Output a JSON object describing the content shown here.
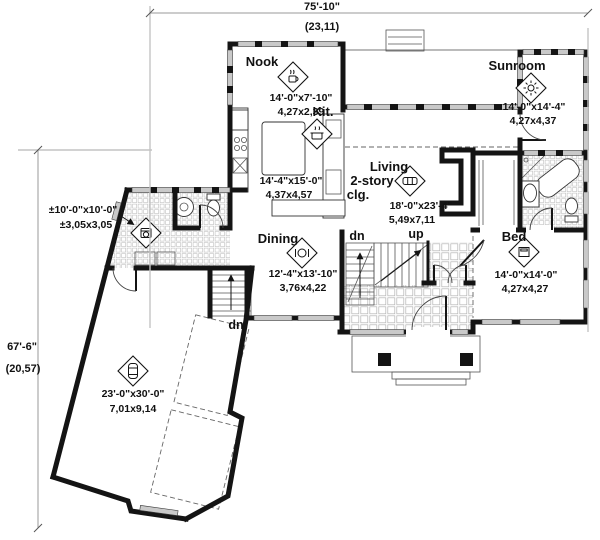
{
  "colors": {
    "wall": "#141414",
    "window_fill": "#c9c9c9",
    "dimension_line": "#9a9a9a",
    "text": "#111111"
  },
  "dimensions": {
    "overall_width_ft": "75'-10\"",
    "overall_width_m": "(23,11)",
    "overall_height_ft": "67'-6\"",
    "overall_height_m": "(20,57)"
  },
  "rooms": {
    "nook": {
      "label": "Nook",
      "size_ft": "14'-0\"x7'-10\"",
      "size_m": "4,27x2,39",
      "icon": "coffee-cup-icon"
    },
    "kitchen": {
      "label": "Kit.",
      "size_ft": "14'-4\"x15'-0\"",
      "size_m": "4,37x4,57",
      "icon": "cooking-pot-icon"
    },
    "sunroom": {
      "label": "Sunroom",
      "size_ft": "14'-0\"x14'-4\"",
      "size_m": "4,27x4,37",
      "icon": "sun-icon"
    },
    "living": {
      "label_line1": "Living",
      "label_line2": "2-story",
      "label_line3": "clg.",
      "size_ft": "18'-0\"x23'-4\"",
      "size_m": "5,49x7,11",
      "icon": "sofa-icon"
    },
    "dining": {
      "label": "Dining",
      "size_ft": "12'-4\"x13'-10\"",
      "size_m": "3,76x4,22",
      "icon": "place-setting-icon"
    },
    "bed": {
      "label": "Bed",
      "size_ft": "14'-0\"x14'-0\"",
      "size_m": "4,27x4,27",
      "icon": "bed-icon"
    },
    "mudroom": {
      "size_ft": "±10'-0\"x10'-0\"",
      "size_m": "±3,05x3,05",
      "icon": "washer-icon"
    },
    "garage": {
      "size_ft": "23'-0\"x30'-0\"",
      "size_m": "7,01x9,14",
      "icon": "car-icon"
    }
  },
  "stairs": {
    "main_down": "dn",
    "main_up": "up",
    "garage_down": "dn"
  }
}
